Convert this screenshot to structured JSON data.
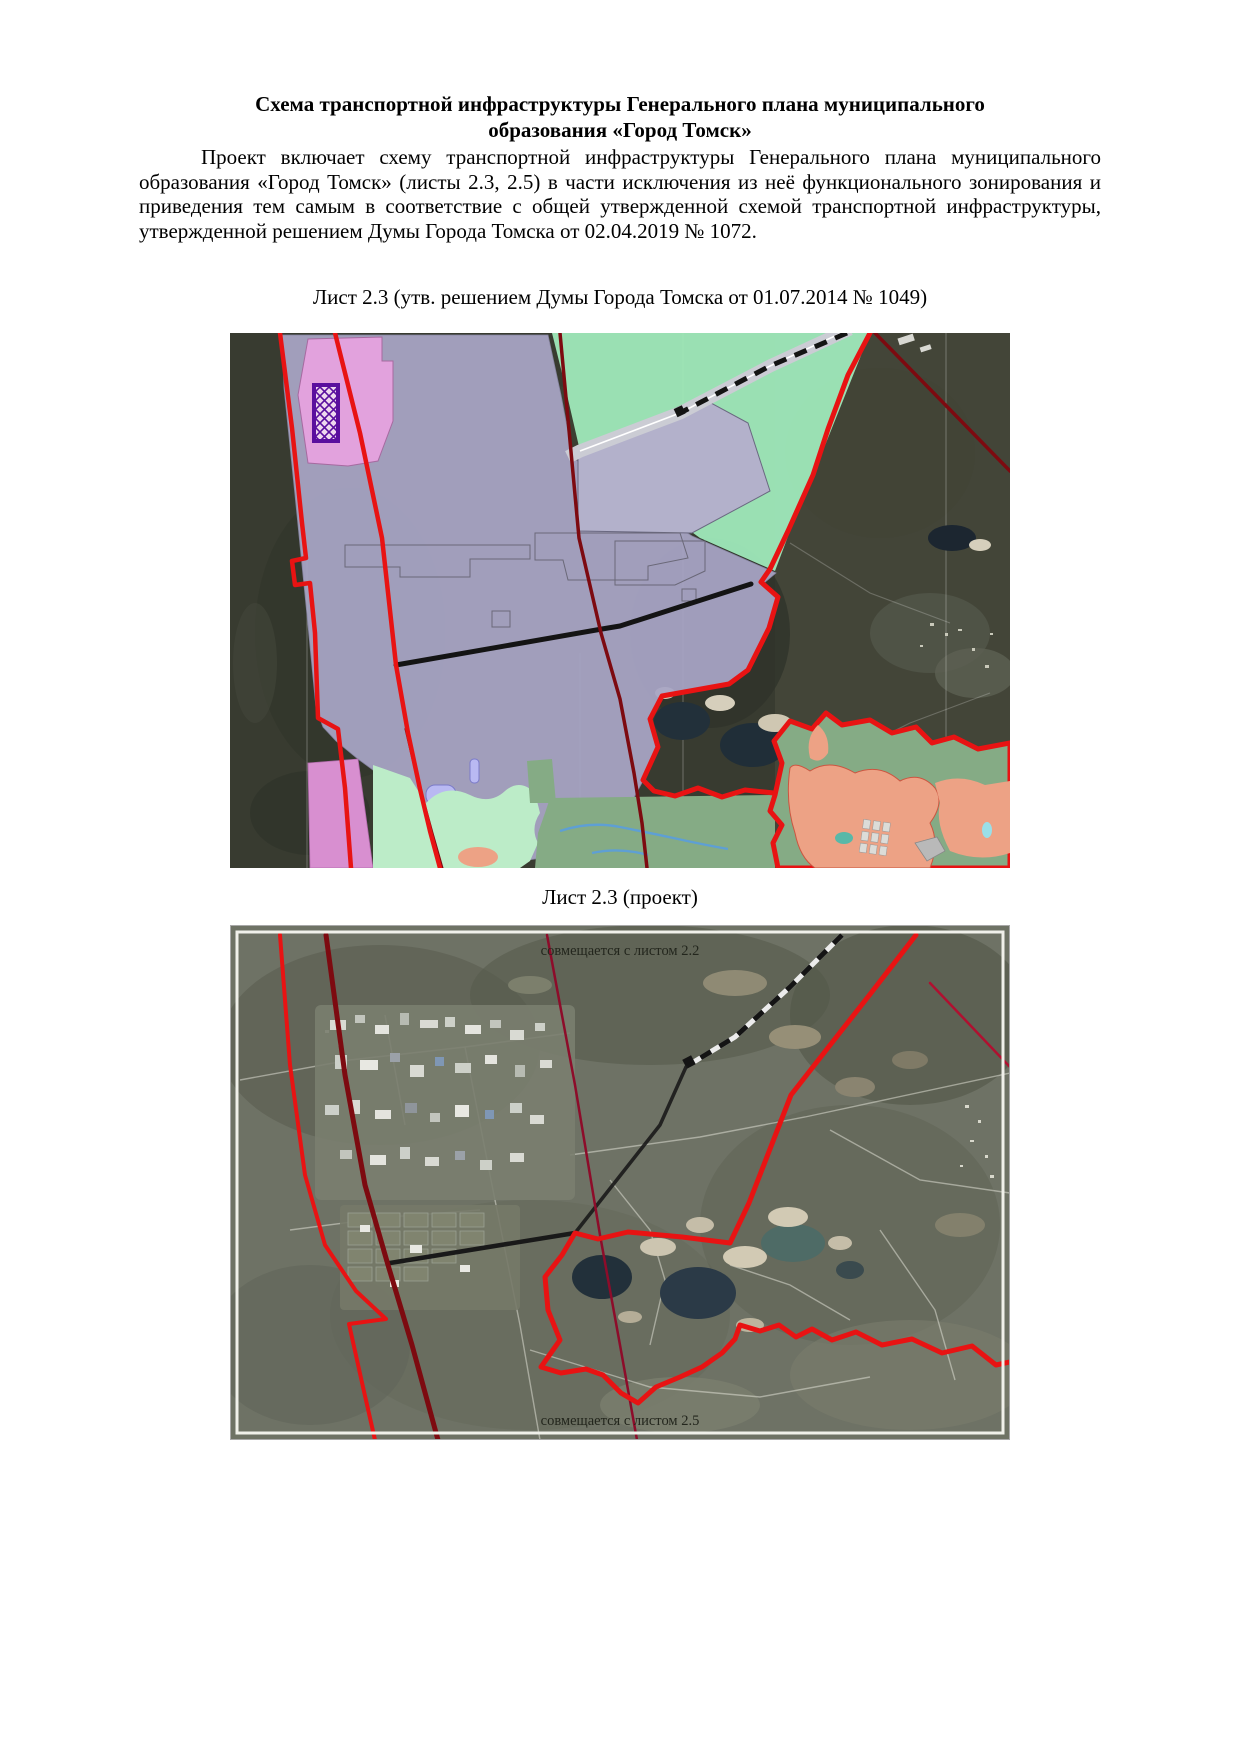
{
  "document": {
    "title": "Схема транспортной инфраструктуры Генерального плана муниципального образования «Город Томск»",
    "paragraph": "Проект включает схему транспортной инфраструктуры Генерального плана муниципального образования «Город Томск» (листы 2.3, 2.5) в части исключения из неё функционального зонирования и приведения тем самым в соответствие с общей утвержденной схемой транспортной инфраструктуры, утвержденной решением Думы Города Томска от 02.04.2019 № 1072."
  },
  "figures": {
    "map1": {
      "caption": "Лист 2.3 (утв. решением Думы Города Томска от 01.07.2014 № 1049)",
      "type": "functional-zoning-over-satellite"
    },
    "map2": {
      "caption": "Лист 2.3 (проект)",
      "label_top": "совмещается с листом 2.2",
      "label_bottom": "совмещается с листом 2.5",
      "type": "satellite-with-transport-lines"
    }
  },
  "colors": {
    "boundary_red": "#e81313",
    "road_dark_red": "#7d0a10",
    "road_maroon_thin": "#8d0c2a",
    "crimson_line": "#b01030",
    "railway_black": "#141414",
    "corridor_gray": "#cbccd4",
    "zone_lavender": "#a9a6c6",
    "zone_industrial": "#b3b1cb",
    "zone_pink": "#e2a2dd",
    "hatch_purple": "#5a0f9e",
    "zone_mint": "#9fe9bb",
    "zone_sage": "#85ab85",
    "zone_lightgreen": "#bcecc8",
    "zone_salmon": "#eda285",
    "zone_pinkviolet": "#d88fd0",
    "water_dark": "#22303a",
    "stream_blue": "#5e9fd4"
  }
}
